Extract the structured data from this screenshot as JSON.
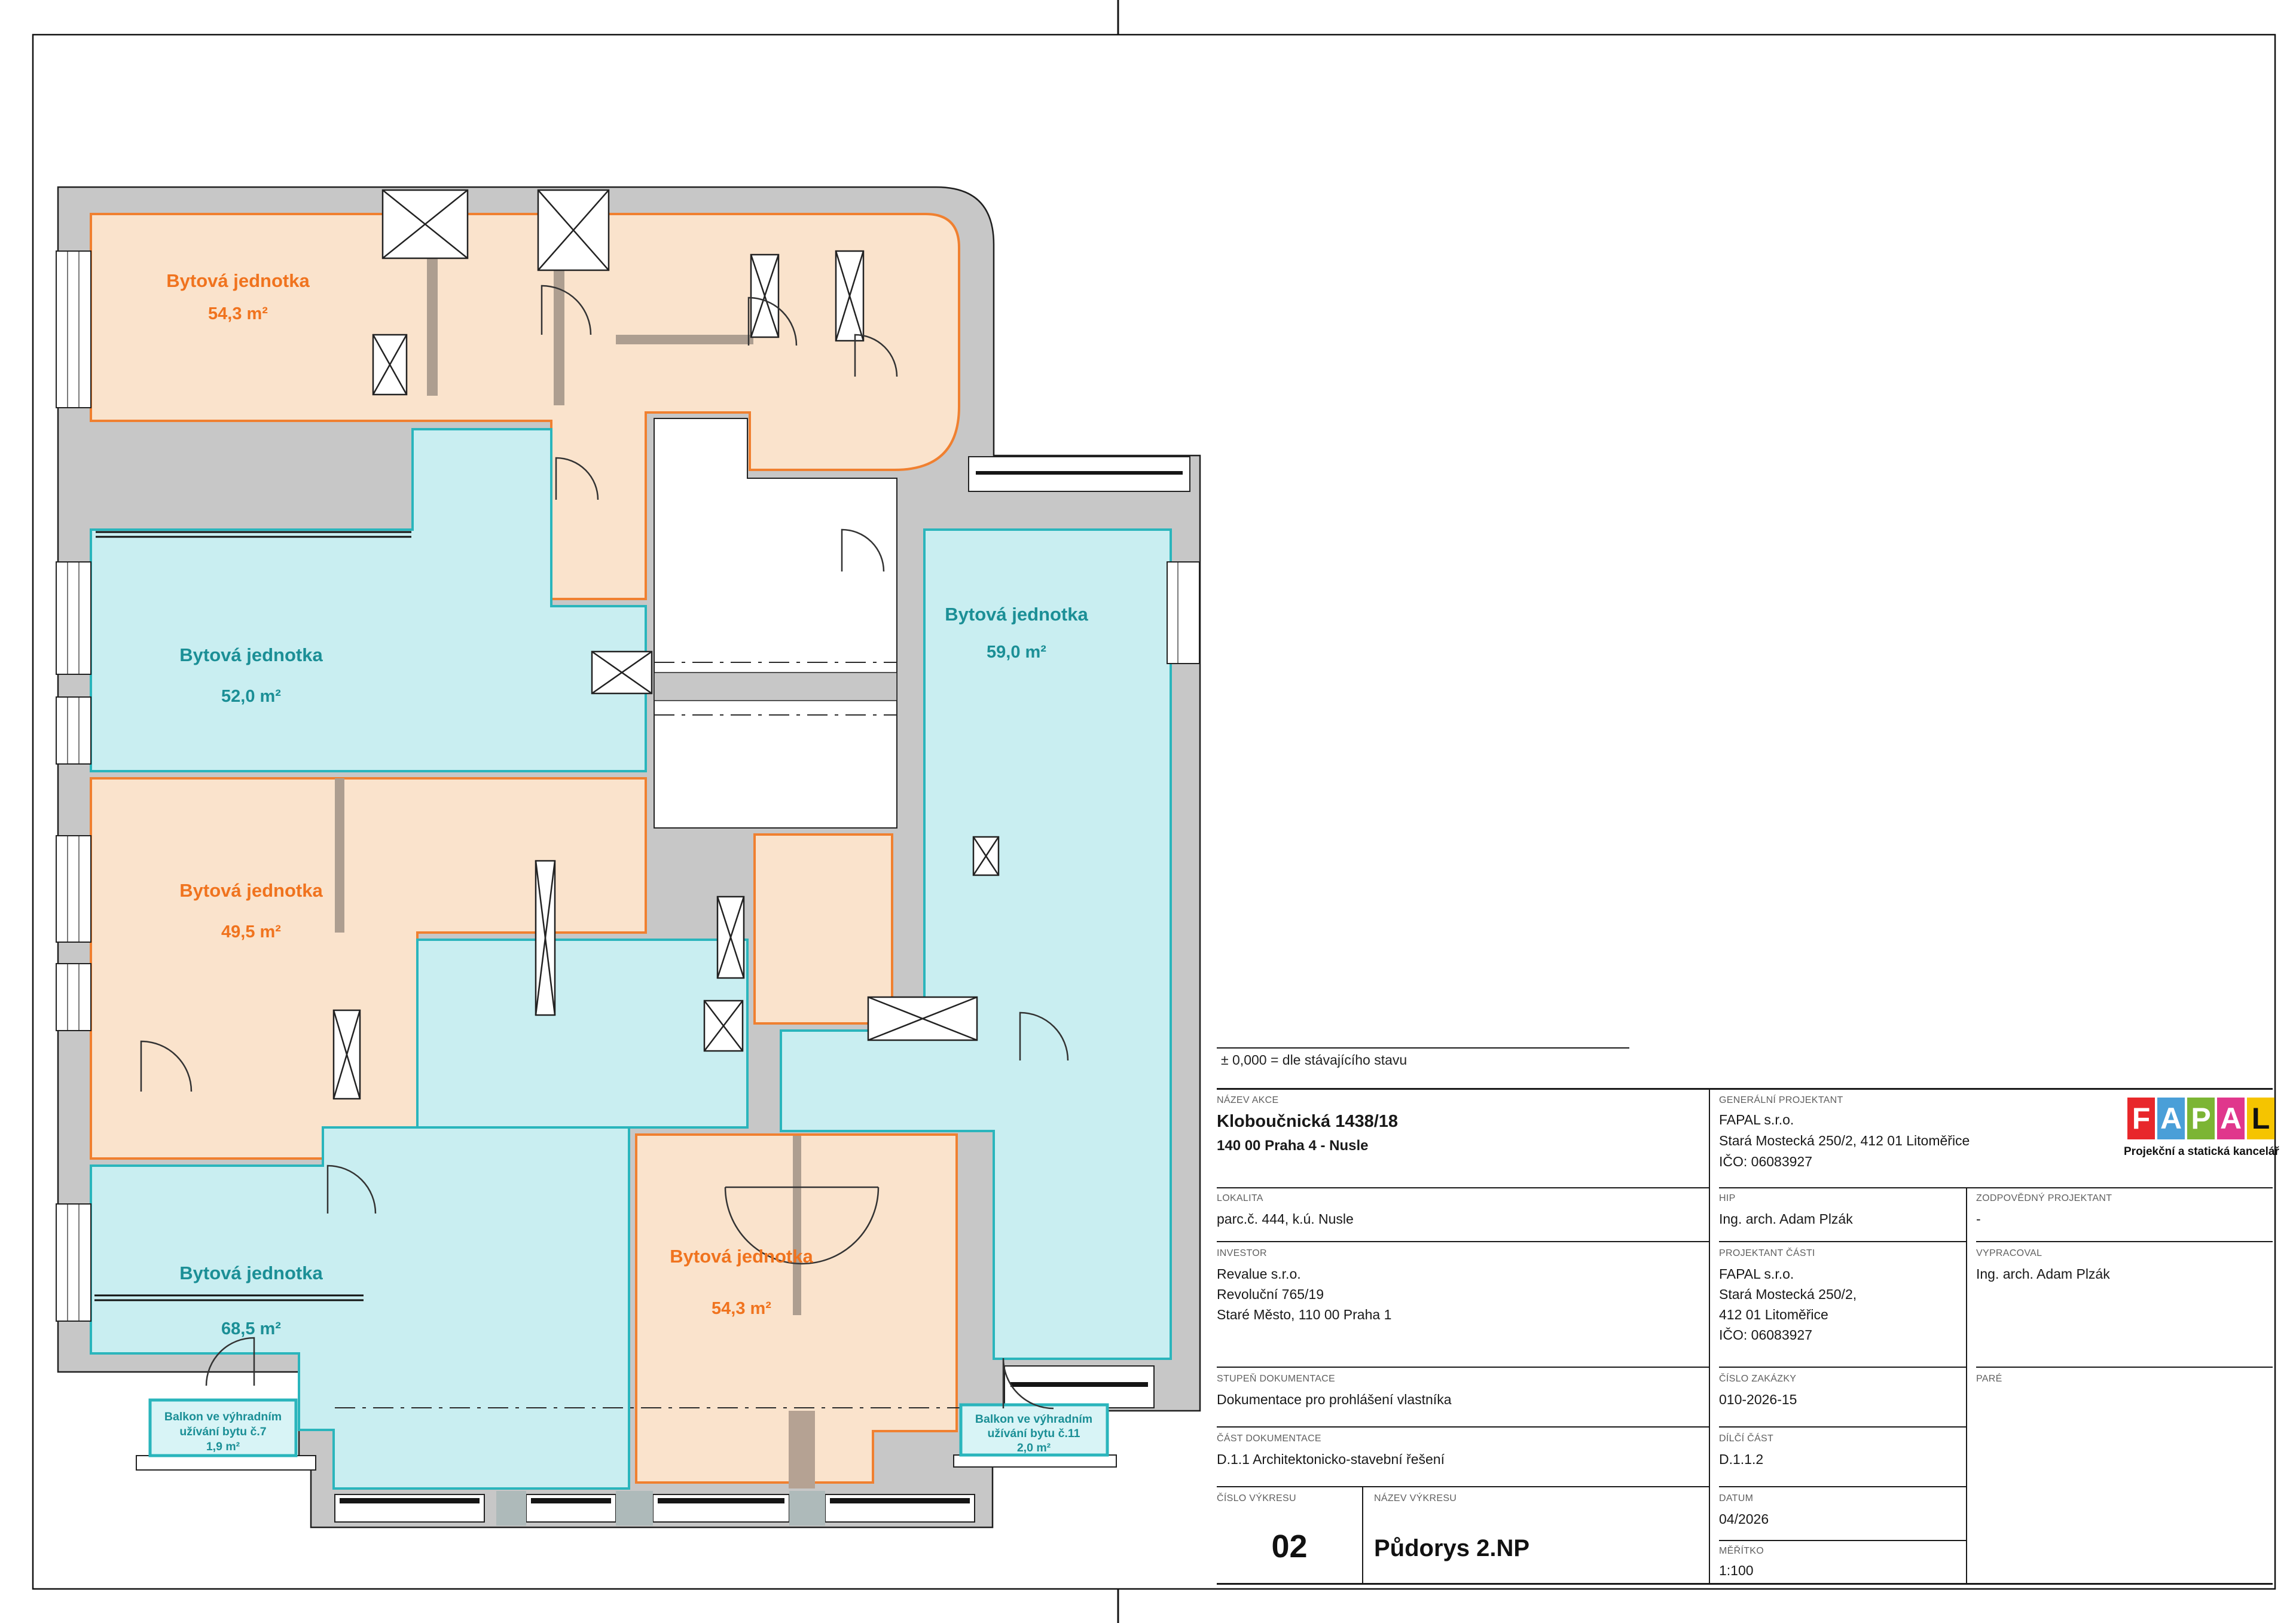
{
  "sheet": {
    "elevation_note": "± 0,000 = dle stávajícího stavu"
  },
  "plan": {
    "colors": {
      "unit_orange_fill": "#FAE3CC",
      "unit_orange_stroke": "#F08030",
      "unit_orange_text": "#F0731E",
      "unit_teal_fill": "#C9EEF1",
      "unit_teal_stroke": "#2AB5BC",
      "unit_teal_text": "#1B8F96",
      "wall_gray": "#C7C7C7"
    },
    "units": [
      {
        "label": "Bytová jednotka",
        "area": "54,3 m²",
        "color": "orange"
      },
      {
        "label": "Bytová jednotka",
        "area": "52,0 m²",
        "color": "teal"
      },
      {
        "label": "Bytová jednotka",
        "area": "49,5 m²",
        "color": "orange"
      },
      {
        "label": "Bytová jednotka",
        "area": "68,5 m²",
        "color": "teal"
      },
      {
        "label": "Bytová jednotka",
        "area": "54,3 m²",
        "color": "orange"
      },
      {
        "label": "Bytová jednotka",
        "area": "59,0 m²",
        "color": "teal"
      }
    ],
    "balconies": [
      {
        "line1": "Balkon ve výhradním",
        "line2": "užívání bytu č.7",
        "line3": "1,9 m²"
      },
      {
        "line1": "Balkon ve výhradním",
        "line2": "užívání bytu č.11",
        "line3": "2,0 m²"
      }
    ]
  },
  "titleblock": {
    "nazev_akce_label": "NÁZEV AKCE",
    "nazev_akce_1": "Kloboučnická 1438/18",
    "nazev_akce_2": "140 00 Praha 4 - Nusle",
    "lokalita_label": "LOKALITA",
    "lokalita": "parc.č. 444, k.ú. Nusle",
    "investor_label": "INVESTOR",
    "investor_1": "Revalue s.r.o.",
    "investor_2": "Revoluční 765/19",
    "investor_3": "Staré Město, 110 00 Praha 1",
    "stupen_label": "STUPEŇ DOKUMENTACE",
    "stupen": "Dokumentace pro prohlášení vlastníka",
    "cast_label": "ČÁST DOKUMENTACE",
    "cast": "D.1.1 Architektonicko-stavební řešení",
    "cislo_vykresu_label": "ČÍSLO VÝKRESU",
    "cislo_vykresu": "02",
    "nazev_vykresu_label": "NÁZEV VÝKRESU",
    "nazev_vykresu": "Půdorys 2.NP",
    "gen_label": "GENERÁLNÍ PROJEKTANT",
    "gen_1": "FAPAL s.r.o.",
    "gen_2": "Stará Mostecká 250/2, 412 01 Litoměřice",
    "gen_3": "IČO: 06083927",
    "hip_label": "HIP",
    "hip": "Ing. arch. Adam Plzák",
    "proj_casti_label": "PROJEKTANT ČÁSTI",
    "proj_casti_1": "FAPAL s.r.o.",
    "proj_casti_2": "Stará Mostecká 250/2,",
    "proj_casti_3": "412 01 Litoměřice",
    "proj_casti_4": "IČO: 06083927",
    "cislo_zakazky_label": "ČÍSLO ZAKÁZKY",
    "cislo_zakazky": "010-2026-15",
    "dilci_label": "DÍLČÍ ČÁST",
    "dilci": "D.1.1.2",
    "datum_label": "DATUM",
    "datum": "04/2026",
    "meritko_label": "MĚŘÍTKO",
    "meritko": "1:100",
    "zodp_label": "ZODPOVĚDNÝ PROJEKTANT",
    "zodp": "-",
    "vypracoval_label": "VYPRACOVAL",
    "vypracoval": "Ing. arch. Adam Plzák",
    "pare_label": "PARÉ",
    "logo": {
      "l1": "F",
      "l2": "A",
      "l3": "P",
      "l4": "A",
      "l5": "L",
      "c1": "#E8272B",
      "c2": "#4A9FD8",
      "c3": "#7CB534",
      "c4": "#E0378C",
      "c5": "#F5C400",
      "caption": "Projekční a statická kancelář"
    }
  }
}
